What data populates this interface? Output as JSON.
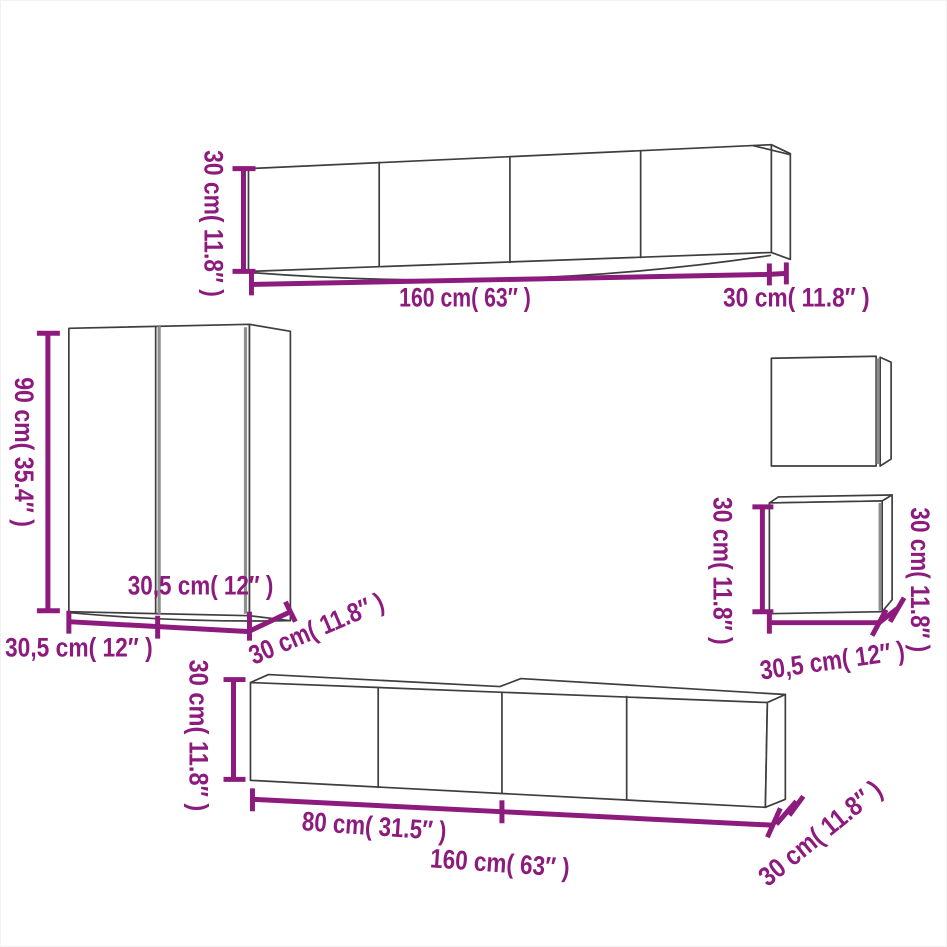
{
  "colors": {
    "background": "#ffffff",
    "outline": "#3e3e3e",
    "door_gap": "#8f8f8f",
    "dimension": "#8d1b7d"
  },
  "cabinets": {
    "top_wall_cabinet": {
      "height": "30 cm( 11.8″ )",
      "width": "160 cm( 63″ )",
      "depth": "30 cm( 11.8″ )"
    },
    "tall_cabinet": {
      "height": "90 cm( 35.4″ )",
      "door_width": "30,5 cm( 12″ )",
      "width": "30,5 cm( 12″ )",
      "depth": "30 cm( 11.8″ )"
    },
    "small_cube_cabinet": {
      "height_left": "30 cm( 11.8″ )",
      "height_right": "30 cm( 11.8″ )",
      "width": "30,5 cm( 12″ )"
    },
    "bottom_tv_bench": {
      "height": "30 cm( 11.8″ )",
      "unit_width": "80 cm( 31.5″ )",
      "width": "160 cm( 63″ )",
      "depth": "30 cm( 11.8″ )"
    }
  }
}
